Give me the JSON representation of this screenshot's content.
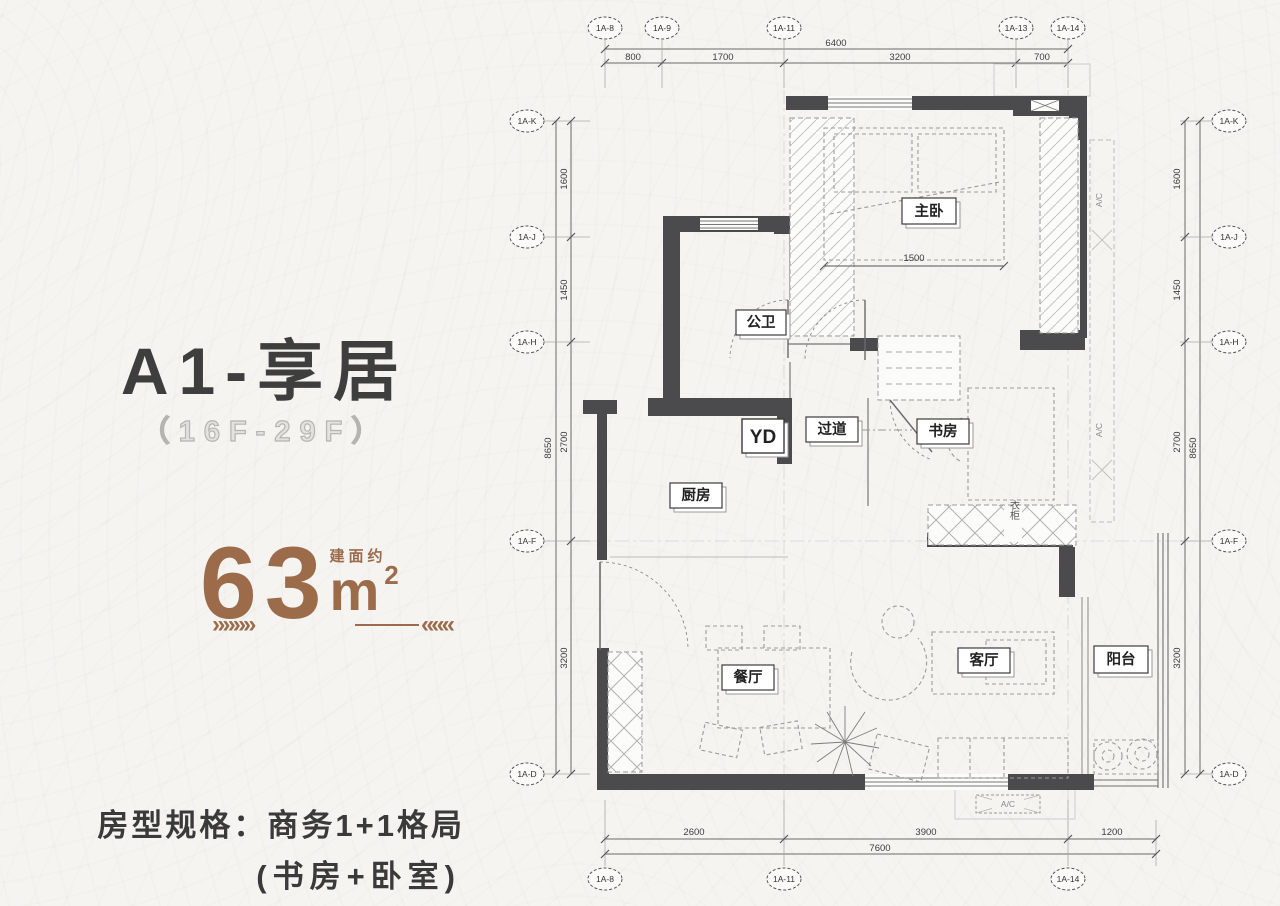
{
  "info_panel": {
    "title": "A1-享居",
    "floor_range": "（16F-29F）",
    "area": {
      "prefix": "建面约",
      "value": "63",
      "unit": "m",
      "sup": "2"
    },
    "arrows_left": "»»»»",
    "arrows_right": "«««",
    "spec_line1": "房型规格：商务1+1格局",
    "spec_line2": "(书房+卧室)"
  },
  "plan": {
    "grid_top": [
      "1A-8",
      "1A-9",
      "1A-11",
      "1A-13",
      "1A-14"
    ],
    "grid_bottom": [
      "1A-8",
      "1A-11",
      "1A-14"
    ],
    "grid_left": [
      "1A-K",
      "1A-J",
      "1A-H",
      "1A-F",
      "1A-D"
    ],
    "grid_right": [
      "1A-K",
      "1A-J",
      "1A-H",
      "1A-F",
      "1A-D"
    ],
    "dims": {
      "top": {
        "total": "6400",
        "segments": [
          "800",
          "1700",
          "3200",
          "700"
        ]
      },
      "bottom": {
        "total": "7600",
        "segments": [
          "2600",
          "3900",
          "1200"
        ]
      },
      "left": {
        "total": "8650",
        "segments": [
          "1600",
          "1450",
          "2700",
          "3200"
        ]
      },
      "right": {
        "total": "8650",
        "segments": [
          "1600",
          "1450",
          "2700",
          "3200"
        ]
      }
    },
    "rooms": {
      "master_bedroom": "主卧",
      "bathroom": "公卫",
      "corridor": "过道",
      "study": "书房",
      "kitchen": "厨房",
      "duct": "YD",
      "dining": "餐厅",
      "living": "客厅",
      "balcony": "阳台",
      "wardrobe": "衣柜",
      "ac_platform": "A/C",
      "ac_side": "A/C"
    },
    "inner_dims": {
      "bed_width": "1500"
    }
  },
  "colors": {
    "accent": "#9c6b4a",
    "title": "#3e3e3e",
    "wall": "#4b4b4d"
  }
}
